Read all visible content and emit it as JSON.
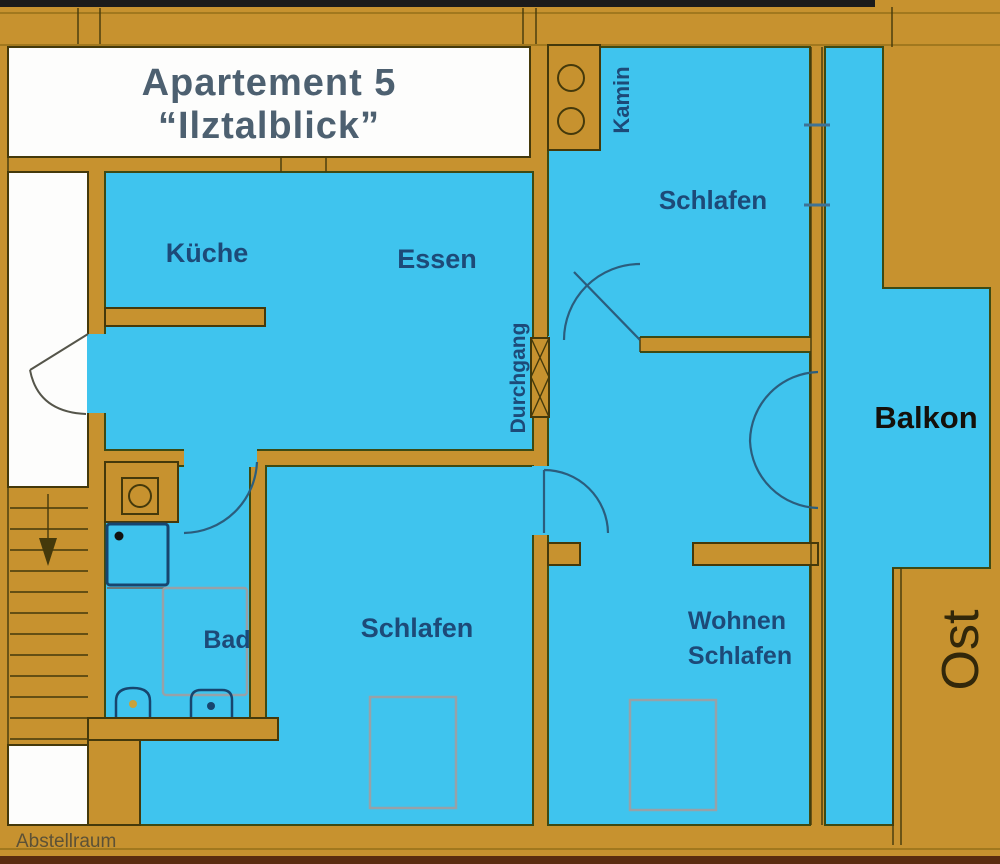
{
  "plan": {
    "title": {
      "line1": "Apartement 5",
      "line2": "“Ilztalblick”"
    },
    "rooms": {
      "kueche": "Küche",
      "essen": "Essen",
      "schlafen_top": "Schlafen",
      "schlafen_bottom": "Schlafen",
      "wohnen_line1": "Wohnen",
      "wohnen_line2": "Schlafen",
      "bad": "Bad",
      "balkon": "Balkon",
      "durchgang": "Durchgang",
      "kamin": "Kamin",
      "abstellraum": "Abstellraum",
      "ost": "Ost"
    },
    "colors": {
      "wall_ochre": "#C7922F",
      "room_blue": "#3FC4EE",
      "outline_dark": "#44390b",
      "label_navy": "#1d4a78",
      "title_gray": "#4d6070",
      "balkon_black": "#14100a",
      "ost_brown": "#32270a",
      "fixture_navy": "#17456e",
      "furniture_gray": "#97a1a8",
      "top_strip_black": "#1b1b1b",
      "bottom_strip_brown": "#5a2c10"
    }
  }
}
